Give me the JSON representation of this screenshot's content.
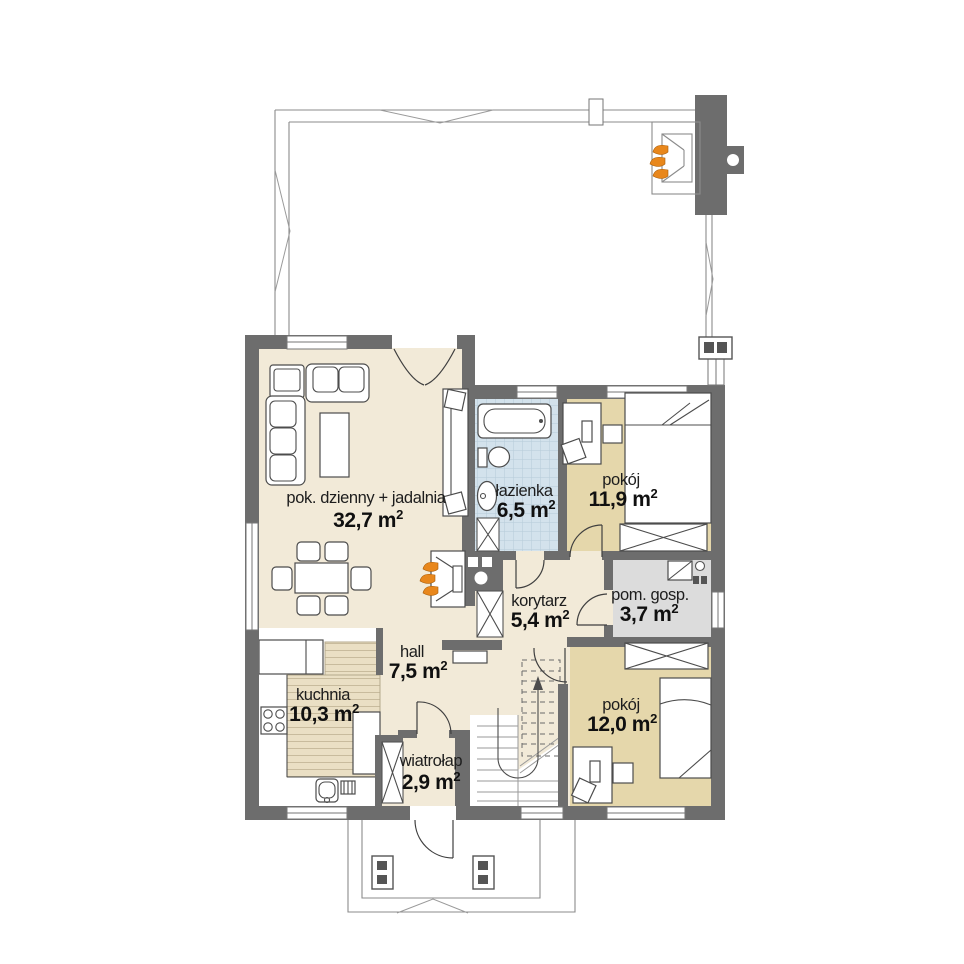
{
  "plan": {
    "rooms": [
      {
        "name": "pok. dzienny + jadalnia",
        "area": "32,7 m",
        "sup": "2"
      },
      {
        "name": "łazienka",
        "area": "6,5 m",
        "sup": "2"
      },
      {
        "name": "pokój",
        "area": "11,9 m",
        "sup": "2"
      },
      {
        "name": "korytarz",
        "area": "5,4 m",
        "sup": "2"
      },
      {
        "name": "pom. gosp.",
        "area": "3,7 m",
        "sup": "2"
      },
      {
        "name": "hall",
        "area": "7,5 m",
        "sup": "2"
      },
      {
        "name": "kuchnia",
        "area": "10,3 m",
        "sup": "2"
      },
      {
        "name": "wiatrołap",
        "area": "2,9 m",
        "sup": "2"
      },
      {
        "name": "pokój",
        "area": "12,0 m",
        "sup": "2"
      }
    ],
    "colors": {
      "wall": "#6d6d6d",
      "floor_main": "#f2ead8",
      "floor_bedroom": "#e5d7ab",
      "floor_bath": "#d3e2ec",
      "floor_utility": "#dcdcdc",
      "flame": "#e8871c"
    }
  }
}
